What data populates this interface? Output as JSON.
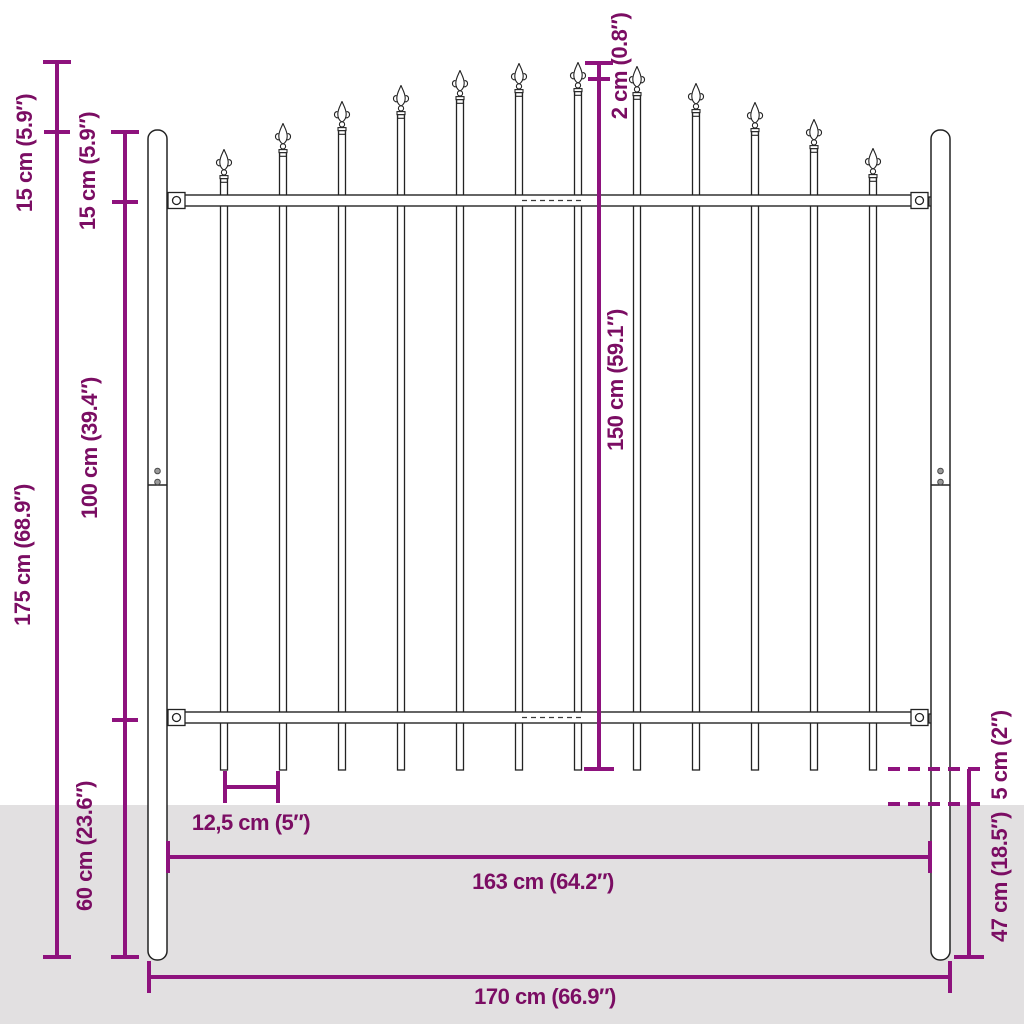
{
  "diagram": {
    "type": "product-dimension-diagram",
    "subject": "garden-fence-panel-with-spear-top-and-posts",
    "colors": {
      "dimension_line": "#8E127D",
      "dimension_text": "#7B0D63",
      "ground": "#E2E0E1",
      "fence_outline": "#232323",
      "background": "#FFFFFF"
    },
    "labels": {
      "arch_rise": "15 cm (5.9″)",
      "post_above_rail": "15 cm (5.9″)",
      "total_height": "175 cm (68.9″)",
      "rail_spacing": "100 cm (39.4″)",
      "post_below_rail": "60 cm (23.6″)",
      "peak_offset": "2 cm (0.8″)",
      "panel_height": "150 cm (59.1″)",
      "picket_spacing": "12,5 cm (5″)",
      "panel_width": "163 cm (64.2″)",
      "total_width": "170 cm (66.9″)",
      "above_ground_gap": "5 cm (2″)",
      "buried_depth": "47 cm (18.5″)"
    }
  }
}
